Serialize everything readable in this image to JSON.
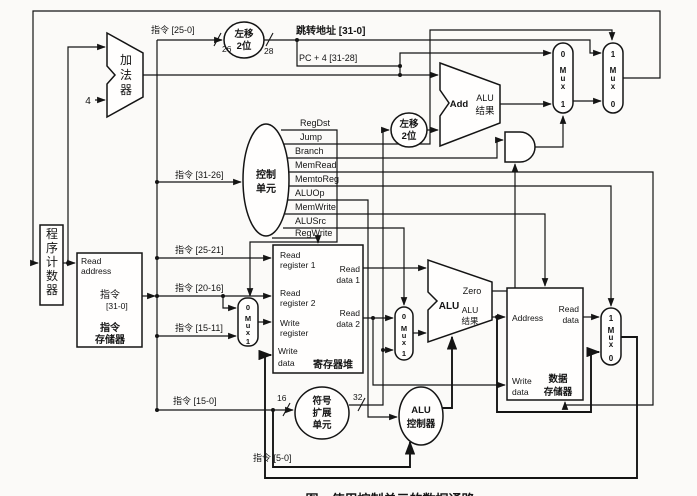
{
  "colors": {
    "ink": "#141414",
    "paper": "#fbfaf8"
  },
  "caption": "图　使用控制单元的数据通路",
  "pc": {
    "c": [
      "程",
      "序",
      "计",
      "数",
      "器"
    ]
  },
  "adder": {
    "c": [
      "加",
      "法",
      "器"
    ],
    "const": "4"
  },
  "imem": {
    "read": "Read",
    "address": "address",
    "out_cn": "指令",
    "out_bits": "[31-0]",
    "name1": "指令",
    "name2": "存储器"
  },
  "fields": {
    "i25_0": "指令 [25-0]",
    "i31_26": "指令  [31-26]",
    "i25_21": "指令  [25-21]",
    "i20_16": "指令  [20-16]",
    "i15_11": "指令  [15-11]",
    "i15_0": "指令  [15-0]",
    "i5_0": "指令  [5-0]"
  },
  "widths": {
    "n26": "26",
    "n28": "28",
    "n16": "16",
    "n32": "32"
  },
  "buses": {
    "jump": "跳转地址  [31-0]",
    "pc4": "PC + 4 [31-28]"
  },
  "shift_top": {
    "l1": "左移",
    "l2": "2位"
  },
  "shift_branch": {
    "l1": "左移",
    "l2": "2位"
  },
  "control": {
    "l1": "控制",
    "l2": "单元",
    "signals": [
      "RegDst",
      "Jump",
      "Branch",
      "MemRead",
      "MemtoReg",
      "ALUOp",
      "MemWrite",
      "ALUSrc",
      "RegWrite"
    ]
  },
  "regfile": {
    "rr1a": "Read",
    "rr1b": "register 1",
    "rr2a": "Read",
    "rr2b": "register 2",
    "wra": "Write",
    "wrb": "register",
    "wda": "Write",
    "wdb": "data",
    "rd1a": "Read",
    "rd1b": "data 1",
    "rd2a": "Read",
    "rd2b": "data 2",
    "name": "寄存器堆"
  },
  "add_branch": {
    "name": "Add",
    "r1": "ALU",
    "r2": "结果"
  },
  "alu": {
    "name": "ALU",
    "zero": "Zero",
    "r1": "ALU",
    "r2": "结果"
  },
  "signext": {
    "l1": "符号",
    "l2": "扩展",
    "l3": "单元"
  },
  "aluctrl": {
    "l1": "ALU",
    "l2": "控制器"
  },
  "dmem": {
    "address": "Address",
    "rda": "Read",
    "rdb": "data",
    "wda": "Write",
    "wdb": "data",
    "n1": "数据",
    "n2": "存储器"
  },
  "mux": {
    "tl": [
      "0",
      "M",
      "u",
      "x",
      "1"
    ],
    "tr": [
      "1",
      "M",
      "u",
      "x",
      "0"
    ],
    "regdst": [
      "0",
      "M",
      "u",
      "x",
      "1"
    ],
    "alusrc": [
      "0",
      "M",
      "u",
      "x",
      "1"
    ],
    "wb": [
      "1",
      "M",
      "u",
      "x",
      "0"
    ]
  }
}
